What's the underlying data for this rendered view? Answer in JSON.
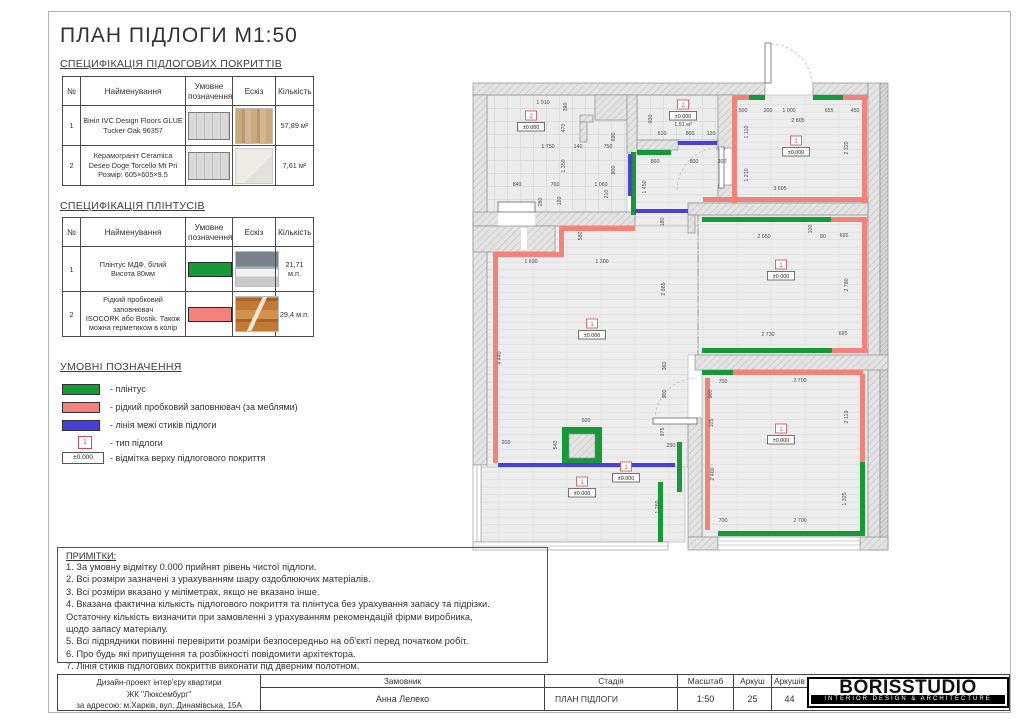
{
  "page": {
    "title": "ПЛАН ПІДЛОГИ М1:50"
  },
  "colors": {
    "skirting_green": "#169a38",
    "cork_pink": "#f2827a",
    "joint_blue": "#4a3fd9",
    "marker_red": "#cc4f4f"
  },
  "floor_spec": {
    "heading": "СПЕЦИФІКАЦІЯ ПІДЛОГОВИХ ПОКРИТТІВ",
    "columns": [
      "№",
      "Найменування",
      "Умовне\nпозначення",
      "Ескіз",
      "Кількість"
    ],
    "rows": [
      {
        "num": "1",
        "name": "Вініл IVC Design Floors GLUE\nTucker Oak 96357",
        "symbol": "floor-hatch-swatch",
        "sketch": "wood-sketch",
        "qty": "57,89 м²"
      },
      {
        "num": "2",
        "name": "Керамограніт Ceramica\nDeseo Doge Torcello Mt Pri\nРозмір: 605×605×9.5",
        "symbol": "floor-hatch-swatch",
        "sketch": "tile-sketch",
        "qty": "7,61 м²"
      }
    ]
  },
  "skirting_spec": {
    "heading": "СПЕЦИФІКАЦІЯ ПЛІНТУСІВ",
    "columns": [
      "№",
      "Найменування",
      "Умовне\nпозначення",
      "Ескіз",
      "Кількість"
    ],
    "rows": [
      {
        "num": "1",
        "name": "Плінтус МДФ, білий\nВисота 80мм",
        "symbol": "green-bar",
        "sketch": "skirting-photo",
        "qty": "21,71 м.п."
      },
      {
        "num": "2",
        "name": "Рідкий пробковий\nзаповнювач\nISOCORK або Bostik. Також\nможна герметиком в колір",
        "symbol": "pink-bar",
        "sketch": "cork-photo",
        "qty": "29,4 м.п."
      }
    ]
  },
  "legend": {
    "heading": "УМОВНІ ПОЗНАЧЕННЯ",
    "items": [
      {
        "swatch": "green-bar",
        "label": "- плінтус"
      },
      {
        "swatch": "pink-bar",
        "label": "- рідкий пробковий заповнювач (за меблями)"
      },
      {
        "swatch": "blue-bar",
        "label": "- лінія межі стиків підлоги"
      },
      {
        "swatch": "type-marker",
        "marker": "1",
        "label": "- тип підлоги"
      },
      {
        "swatch": "elevation-mark",
        "marker": "±0.000",
        "label": "- відмітка верху підлогового покриття"
      }
    ]
  },
  "notes": {
    "heading": "ПРИМІТКИ:",
    "lines": [
      "1. За умовну відмітку 0.000 прийнят рівень чистої підлоги.",
      "2. Всі розміри зазначені з урахуванням шару оздоблюючих матеріалів.",
      "3. Всі розміри вказано у міліметрах, якщо не вказано інше.",
      "4. Вказана фактична кількість підлогового покриття та плінтуса без урахування запасу та підрізки.",
      "Остаточну кількість визначити при замовленні з урахуванням рекомендацій фірми виробника,",
      "щодо запасу матеріалу.",
      "5. Всі підрядники повинні перевірити розміри безпосередньо на об'єкті перед початком робіт.",
      "6. Про будь які припущення та розбіжності повідомити архітектора.",
      "7.  Лінія стиків підлогових покриттів виконати під дверним полотном."
    ]
  },
  "titleblock": {
    "project_lines": "Дизайн-проект інтер'єру квартири\nЖК \"Люксембург\"\nза адресою: м.Харків, вул. Динамівська, 15А",
    "client_label": "Замовник",
    "client_value": "Анна Лелеко",
    "stage_label": "Стадія",
    "stage_value": "ПЛАН ПІДЛОГИ",
    "scale_label": "Масштаб",
    "scale_value": "1:50",
    "sheet_label": "Аркуш",
    "sheet_value": "25",
    "sheets_label": "Аркушів",
    "sheets_value": "44",
    "logo": "BORISSTUDIO",
    "logo_sub": "INTERIOR DESIGN & ARCHITECTURE"
  },
  "plan": {
    "dims": [
      {
        "t": "1 910",
        "x": 88,
        "y": 74
      },
      {
        "t": "390",
        "x": 112,
        "y": 77,
        "r": 1
      },
      {
        "t": "470",
        "x": 110,
        "y": 98,
        "r": 1
      },
      {
        "t": "1 750",
        "x": 93,
        "y": 118
      },
      {
        "t": "140",
        "x": 123,
        "y": 118
      },
      {
        "t": "750",
        "x": 153,
        "y": 118
      },
      {
        "t": "690",
        "x": 160,
        "y": 107,
        "r": 1
      },
      {
        "t": "1 350",
        "x": 110,
        "y": 136,
        "r": 1
      },
      {
        "t": "800",
        "x": 160,
        "y": 140,
        "r": 1
      },
      {
        "t": "840",
        "x": 62,
        "y": 156
      },
      {
        "t": "760",
        "x": 100,
        "y": 156
      },
      {
        "t": "1 060",
        "x": 146,
        "y": 156
      },
      {
        "t": "210",
        "x": 153,
        "y": 164,
        "r": 1
      },
      {
        "t": "280",
        "x": 87,
        "y": 172,
        "r": 1
      },
      {
        "t": "120",
        "x": 106,
        "y": 171,
        "r": 1
      },
      {
        "t": "930",
        "x": 197,
        "y": 89,
        "r": 1
      },
      {
        "t": "610",
        "x": 207,
        "y": 105
      },
      {
        "t": "800",
        "x": 235,
        "y": 105
      },
      {
        "t": "120",
        "x": 256,
        "y": 105
      },
      {
        "t": "860",
        "x": 200,
        "y": 133
      },
      {
        "t": "800",
        "x": 239,
        "y": 133
      },
      {
        "t": "300",
        "x": 267,
        "y": 133
      },
      {
        "t": "1 450",
        "x": 191,
        "y": 157,
        "r": 1
      },
      {
        "t": "180",
        "x": 209,
        "y": 192,
        "r": 1
      },
      {
        "t": "500",
        "x": 288,
        "y": 82
      },
      {
        "t": "200",
        "x": 313,
        "y": 82
      },
      {
        "t": "1 000",
        "x": 334,
        "y": 82
      },
      {
        "t": "655",
        "x": 374,
        "y": 82
      },
      {
        "t": "450",
        "x": 400,
        "y": 82
      },
      {
        "t": "2 805",
        "x": 343,
        "y": 92
      },
      {
        "t": "1 110",
        "x": 293,
        "y": 102,
        "r": 1
      },
      {
        "t": "2 320",
        "x": 393,
        "y": 118,
        "r": 1
      },
      {
        "t": "1 210",
        "x": 293,
        "y": 145,
        "r": 1
      },
      {
        "t": "3 605",
        "x": 325,
        "y": 160
      },
      {
        "t": "2 650",
        "x": 309,
        "y": 208
      },
      {
        "t": "100",
        "x": 357,
        "y": 199,
        "r": 1
      },
      {
        "t": "80",
        "x": 368,
        "y": 208
      },
      {
        "t": "695",
        "x": 389,
        "y": 207
      },
      {
        "t": "2 780",
        "x": 393,
        "y": 255,
        "r": 1
      },
      {
        "t": "2 730",
        "x": 313,
        "y": 306
      },
      {
        "t": "695",
        "x": 388,
        "y": 305
      },
      {
        "t": "2 885",
        "x": 210,
        "y": 259,
        "r": 1
      },
      {
        "t": "580",
        "x": 127,
        "y": 206,
        "r": 1
      },
      {
        "t": "1 690",
        "x": 76,
        "y": 233
      },
      {
        "t": "1 300",
        "x": 147,
        "y": 233
      },
      {
        "t": "4 440",
        "x": 46,
        "y": 328,
        "r": 1
      },
      {
        "t": "360",
        "x": 211,
        "y": 336,
        "r": 1
      },
      {
        "t": "900",
        "x": 211,
        "y": 364,
        "r": 1
      },
      {
        "t": "900",
        "x": 257,
        "y": 364,
        "r": 1
      },
      {
        "t": "975",
        "x": 209,
        "y": 402,
        "r": 1
      },
      {
        "t": "290",
        "x": 216,
        "y": 417
      },
      {
        "t": "500",
        "x": 131,
        "y": 392
      },
      {
        "t": "540",
        "x": 102,
        "y": 415,
        "r": 1
      },
      {
        "t": "200",
        "x": 51,
        "y": 414
      },
      {
        "t": "1 260",
        "x": 204,
        "y": 477,
        "r": 1
      },
      {
        "t": "700",
        "x": 268,
        "y": 353
      },
      {
        "t": "2 700",
        "x": 345,
        "y": 352
      },
      {
        "t": "105",
        "x": 258,
        "y": 393,
        "r": 1
      },
      {
        "t": "2 119",
        "x": 393,
        "y": 387,
        "r": 1
      },
      {
        "t": "2 400",
        "x": 259,
        "y": 444,
        "r": 1
      },
      {
        "t": "1 325",
        "x": 391,
        "y": 469,
        "r": 1
      },
      {
        "t": "700",
        "x": 268,
        "y": 492
      },
      {
        "t": "2 700",
        "x": 345,
        "y": 492
      }
    ],
    "markers": [
      {
        "n": "2",
        "e": "±0.000",
        "x": 76,
        "y": 88
      },
      {
        "n": "2",
        "e": "±0.000",
        "a": "1,51 м²",
        "x": 228,
        "y": 77
      },
      {
        "n": "1",
        "e": "±0.000",
        "x": 341,
        "y": 113
      },
      {
        "n": "1",
        "e": "±0.000",
        "x": 326,
        "y": 237
      },
      {
        "n": "1",
        "e": "±0.000",
        "x": 137,
        "y": 296
      },
      {
        "n": "1",
        "e": "±0.000",
        "x": 326,
        "y": 401
      },
      {
        "n": "1",
        "e": "±0.000",
        "x": 171,
        "y": 439
      },
      {
        "n": "1",
        "e": "±0.000",
        "x": 127,
        "y": 454
      }
    ]
  }
}
